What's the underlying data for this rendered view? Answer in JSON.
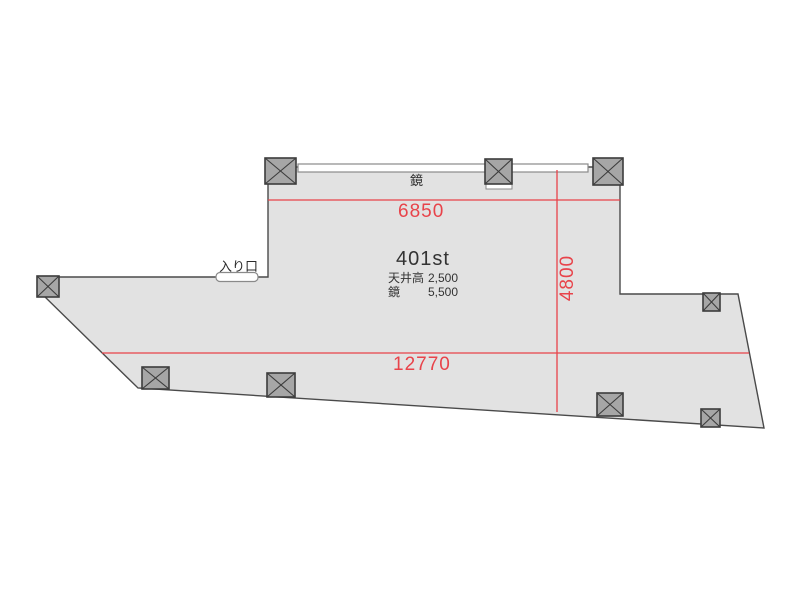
{
  "plan": {
    "room_title": "401st",
    "specs": [
      {
        "label": "天井高",
        "value": "2,500"
      },
      {
        "label": "鏡",
        "value": "5,500"
      }
    ],
    "labels": {
      "mirror": "鏡",
      "entrance": "入り口"
    },
    "dimensions": {
      "top_width": "6850",
      "bottom_width": "12770",
      "height": "4800"
    },
    "colors": {
      "dimension_red": "#e8434a",
      "floor_fill": "#e2e2e2",
      "wall_stroke": "#4a4a4a",
      "column_fill": "#a6a6a6",
      "column_stroke": "#3c3c3c"
    }
  }
}
